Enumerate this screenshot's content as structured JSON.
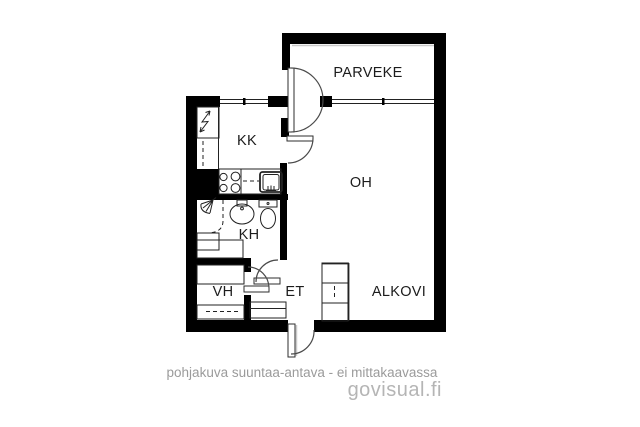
{
  "plan": {
    "rooms": {
      "parveke": "PARVEKE",
      "kk": "KK",
      "oh": "OH",
      "kh": "KH",
      "vh": "VH",
      "et": "ET",
      "alkovi": "ALKOVI"
    }
  },
  "footer": {
    "disclaimer": "pohjakuva suuntaa-antava - ei mittakaavassa",
    "brand": "govisual.fi"
  },
  "colors": {
    "background": "#ffffff",
    "wall": "#000000",
    "line": "#222222",
    "arc": "#4a4a4a",
    "label": "#1c1c1c",
    "shadow": "#c9c9c9",
    "disclaimer": "#9b9b9b",
    "brand": "#b5b5b5"
  },
  "icons": [
    "lightning-icon",
    "stove-icon",
    "sink-icon",
    "shower-icon",
    "washbasin-icon",
    "toilet-icon"
  ]
}
